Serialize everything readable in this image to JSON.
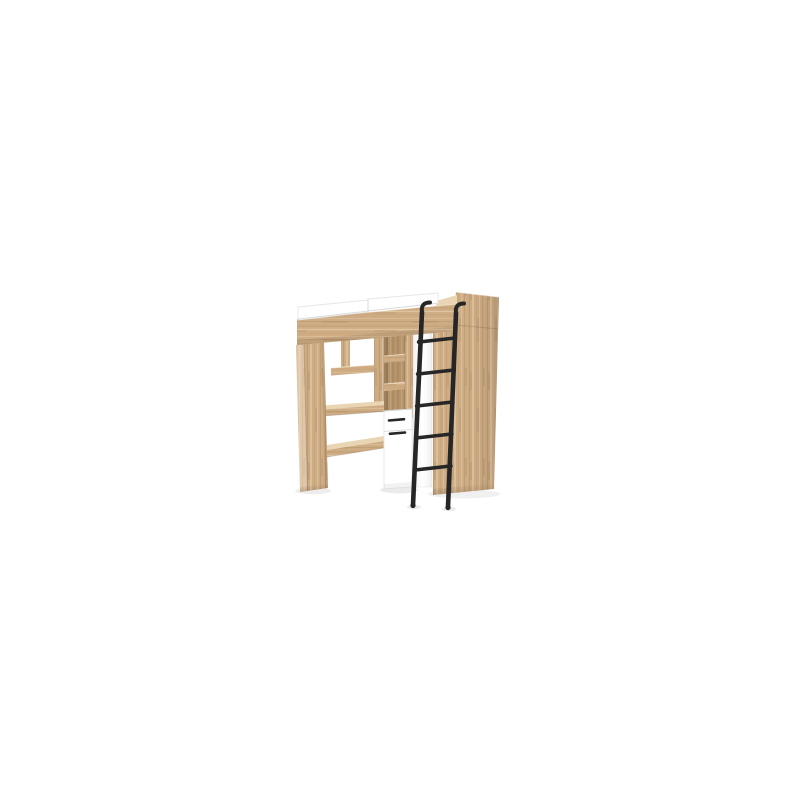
{
  "meta": {
    "description": "Loft bed in light oak with desk, hanging shelves, shelf column, white drawer cabinet, wardrobe and black metal ladder on white background"
  },
  "colors": {
    "background": "#ffffff",
    "oak_base": "#cfad84",
    "oak_light": "#e0c49d",
    "oak_lighter": "#e9d5b4",
    "oak_dark": "#b6946c",
    "oak_deep": "#9a7c55",
    "white_panel": "#ffffff",
    "white_edge": "#e4e4e4",
    "divider_gray": "#d8d8d8",
    "ladder": "#262626",
    "shadow": "#000000"
  }
}
